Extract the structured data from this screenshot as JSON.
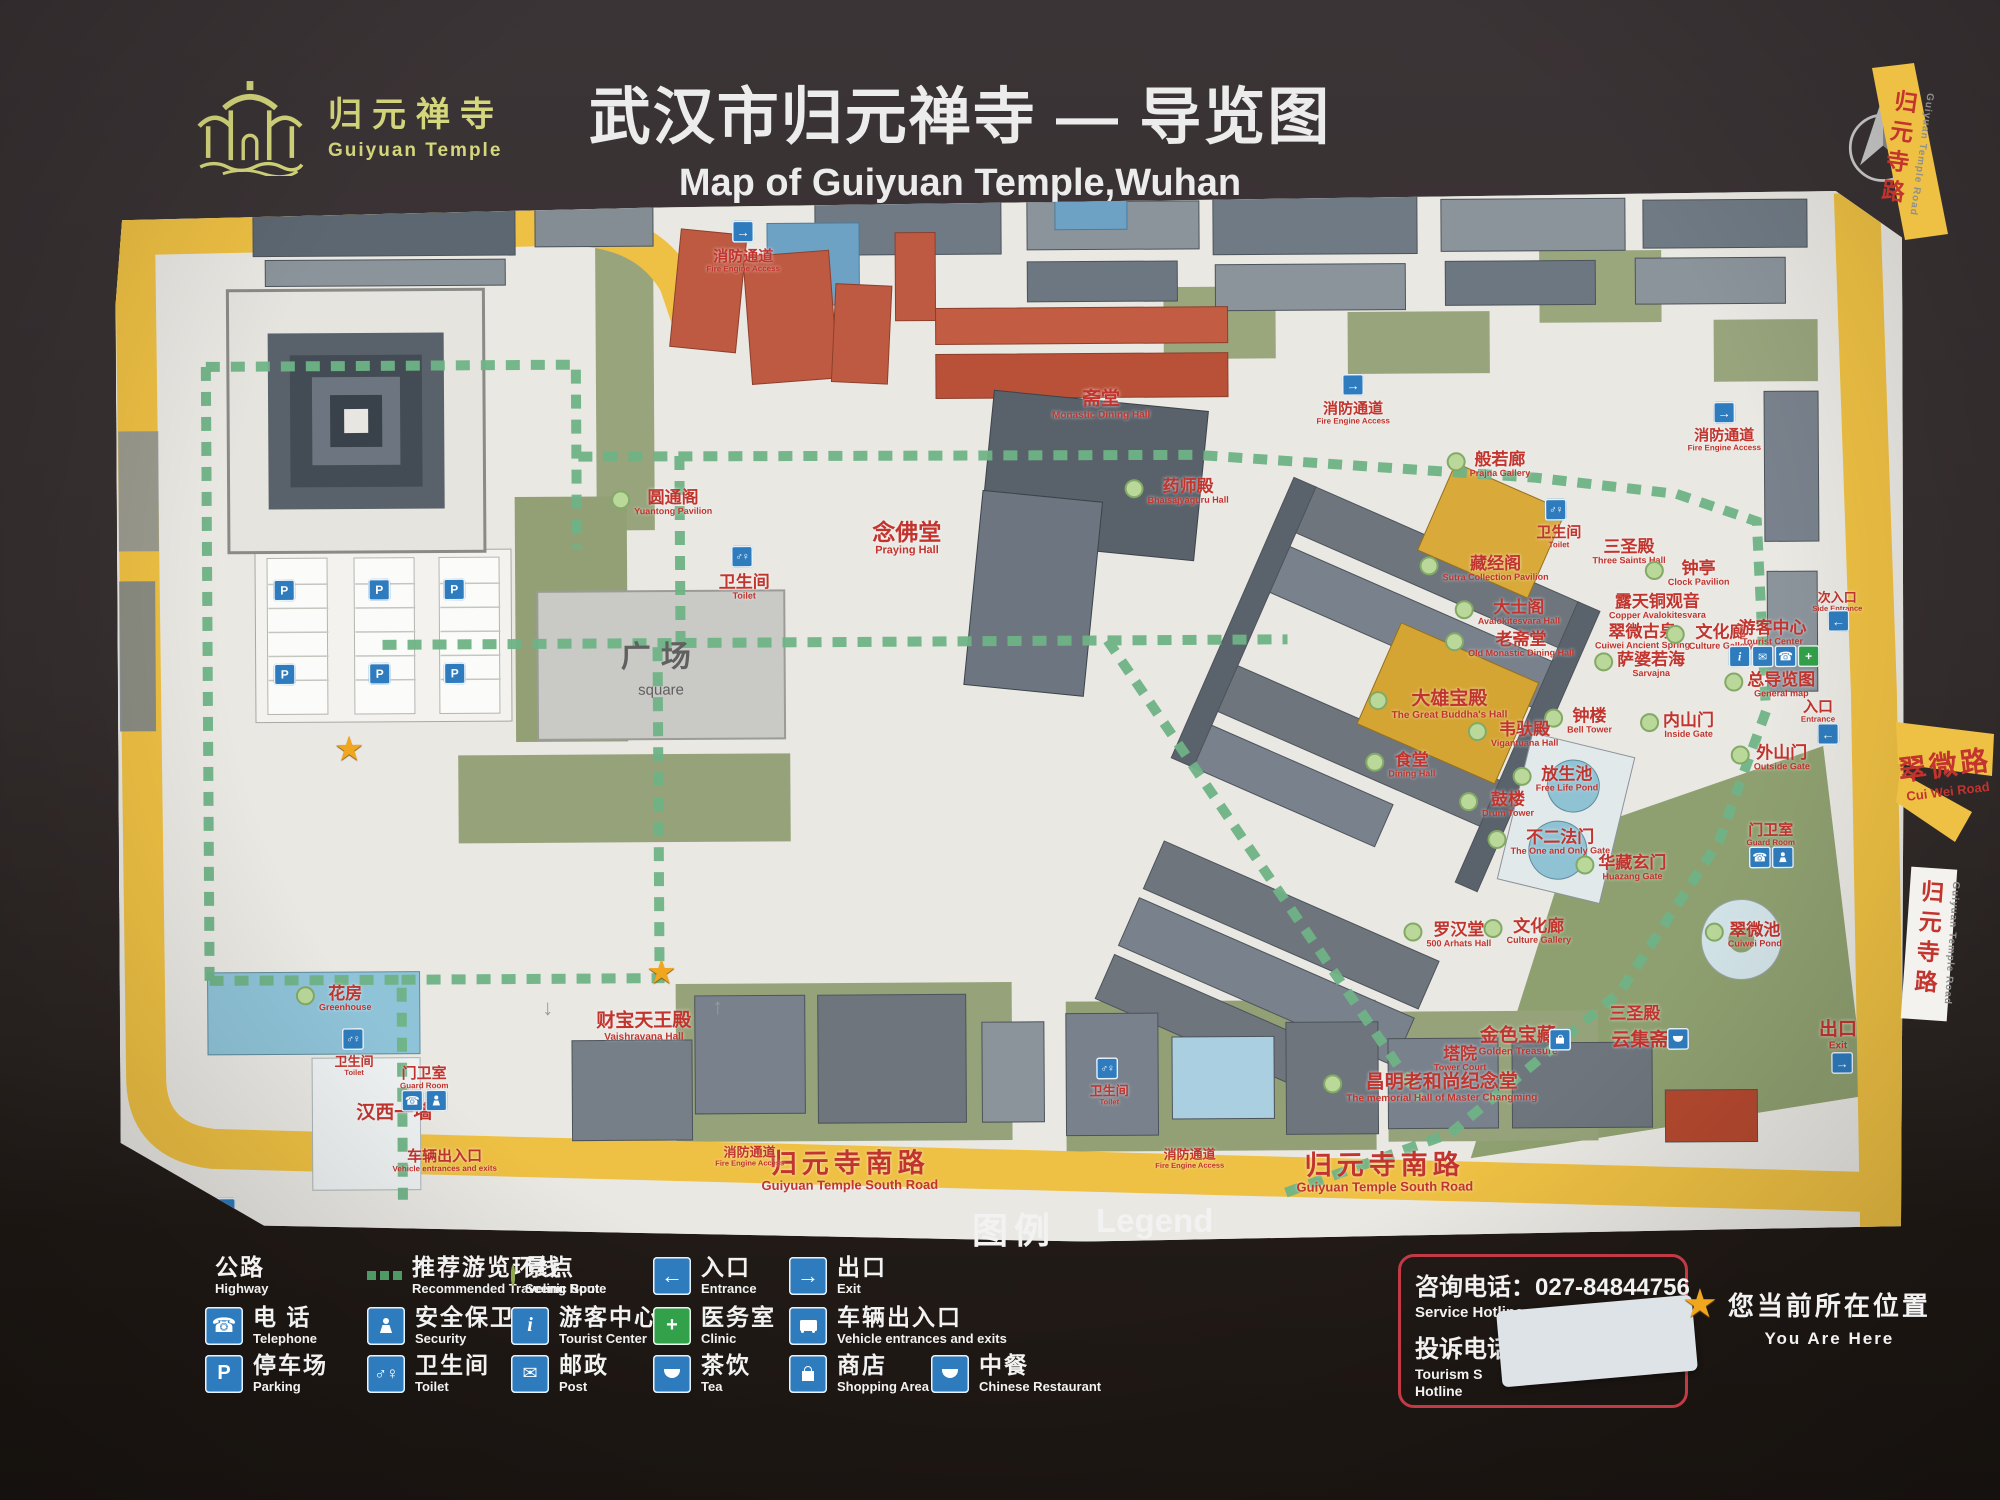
{
  "logo": {
    "cn": "归元禅寺",
    "en": "Guiyuan Temple"
  },
  "title": {
    "cn": "武汉市归元禅寺 — 导览图",
    "en": "Map of Guiyuan Temple,Wuhan"
  },
  "compass": {
    "label": "N"
  },
  "colors": {
    "road_yellow": "#eec043",
    "label_red": "#c2342e",
    "route_green": "#6fb386",
    "spot_green": "#b9d89a",
    "sign_blue": "#2e7cbe",
    "clinic_green": "#33a04a",
    "logo_yellow": "#d5d77c"
  },
  "map": {
    "square": {
      "cn": "广场",
      "en": "square"
    },
    "roads_outside": {
      "guiyuan_road": {
        "zh": "归元寺路",
        "en": "Guiyuan Temple Road"
      },
      "cuiwei_road": {
        "zh": "翠微路",
        "en": "Cui Wei Road"
      }
    },
    "labels": [
      {
        "zh": "消防通道",
        "en": "Fire Engine Access",
        "x": 628,
        "y": 64,
        "c": "sm"
      },
      {
        "zh": "圆通阁",
        "en": "Yuantong Pavilion",
        "x": 545,
        "y": 305,
        "d": 1
      },
      {
        "zh": "卫生间",
        "en": "Toilet",
        "x": 627,
        "y": 390
      },
      {
        "zh": "念佛堂",
        "en": "Praying Hall",
        "x": 790,
        "y": 342,
        "c": "lg"
      },
      {
        "zh": "斋堂",
        "en": "Monastic Dining Hall",
        "x": 985,
        "y": 210,
        "c": "md"
      },
      {
        "zh": "消防通道",
        "en": "Fire Engine Access",
        "x": 1237,
        "y": 220,
        "c": "sm"
      },
      {
        "zh": "消防通道",
        "en": "Fire Engine Access",
        "x": 1608,
        "y": 249,
        "c": "sm"
      },
      {
        "zh": "般若廊",
        "en": "Prajna Gallery",
        "x": 1372,
        "y": 272,
        "d": 1
      },
      {
        "zh": "药师殿",
        "en": "Bhaisajyaguru Hall",
        "x": 1060,
        "y": 297,
        "d": 1
      },
      {
        "zh": "藏经阁",
        "en": "Sutra Collection Pavilion",
        "x": 1367,
        "y": 376,
        "d": 1
      },
      {
        "zh": "卫生间",
        "en": "Toilet",
        "x": 1442,
        "y": 345,
        "c": "sm"
      },
      {
        "zh": "三圣殿",
        "en": "Three Saints Hall",
        "x": 1512,
        "y": 360
      },
      {
        "zh": "钟亭",
        "en": "Clock Pavilion",
        "x": 1570,
        "y": 382,
        "d": 1
      },
      {
        "zh": "露天铜观音",
        "en": "Copper Avalokitesvara",
        "x": 1540,
        "y": 415
      },
      {
        "zh": "翠微古泉",
        "en": "Cuiwei Ancient Spring",
        "x": 1525,
        "y": 445
      },
      {
        "zh": "文化廊",
        "en": "Culture Gallery",
        "x": 1592,
        "y": 446,
        "d": 1
      },
      {
        "zh": "游客中心",
        "en": "Tourist Center",
        "x": 1655,
        "y": 442
      },
      {
        "zh": "萨婆若海",
        "en": "Sarvajna",
        "x": 1522,
        "y": 473,
        "d": 1
      },
      {
        "zh": "总导览图",
        "en": "General map",
        "x": 1652,
        "y": 494,
        "d": 1
      },
      {
        "zh": "次入口",
        "en": "Side Entrance",
        "x": 1720,
        "y": 411,
        "c": "xs"
      },
      {
        "zh": "入口",
        "en": "Entrance",
        "x": 1700,
        "y": 521,
        "c": "sm"
      },
      {
        "zh": "外山门",
        "en": "Outside Gate",
        "x": 1652,
        "y": 567,
        "d": 1
      },
      {
        "zh": "内山门",
        "en": "Inside Gate",
        "x": 1559,
        "y": 534,
        "d": 1
      },
      {
        "zh": "钟楼",
        "en": "Bell Tower",
        "x": 1460,
        "y": 529,
        "d": 1
      },
      {
        "zh": "大士阁",
        "en": "Avalokitesvara Hall",
        "x": 1390,
        "y": 420,
        "d": 1
      },
      {
        "zh": "老斋堂",
        "en": "Old Monastic Dining Hall",
        "x": 1392,
        "y": 452,
        "d": 1
      },
      {
        "zh": "大雄宝殿",
        "en": "The Great Buddha's Hall",
        "x": 1320,
        "y": 512,
        "d": 1,
        "c": "md"
      },
      {
        "zh": "韦驮殿",
        "en": "Vigantuana Hall",
        "x": 1395,
        "y": 542,
        "d": 1
      },
      {
        "zh": "食堂",
        "en": "Dining Hall",
        "x": 1282,
        "y": 572,
        "d": 1
      },
      {
        "zh": "放生池",
        "en": "Free Life Pond",
        "x": 1437,
        "y": 587,
        "d": 1
      },
      {
        "zh": "鼓楼",
        "en": "Drum Tower",
        "x": 1378,
        "y": 612,
        "d": 1
      },
      {
        "zh": "不二法门",
        "en": "The One and Only Gate",
        "x": 1430,
        "y": 650,
        "d": 1
      },
      {
        "zh": "华藏玄门",
        "en": "Huazang Gate",
        "x": 1502,
        "y": 676,
        "d": 1
      },
      {
        "zh": "罗汉堂",
        "en": "500 Arhats Hall",
        "x": 1328,
        "y": 742,
        "d": 1
      },
      {
        "zh": "文化廊",
        "en": "Culture Gallery",
        "x": 1408,
        "y": 739,
        "d": 1
      },
      {
        "zh": "翠微池",
        "en": "Cuiwei Pond",
        "x": 1624,
        "y": 744,
        "d": 1
      },
      {
        "zh": "三圣殿",
        "en": "",
        "x": 1515,
        "y": 822
      },
      {
        "zh": "金色宝藏",
        "en": "Golden Treasure",
        "x": 1398,
        "y": 849,
        "c": "md"
      },
      {
        "zh": "云集斋",
        "en": "",
        "x": 1520,
        "y": 849,
        "c": "md"
      },
      {
        "zh": "塔院",
        "en": "Tower Court",
        "x": 1340,
        "y": 866
      },
      {
        "zh": "昌明老和尚纪念堂",
        "en": "The memorial Hall of Master Changming",
        "x": 1310,
        "y": 895,
        "d": 1,
        "c": "md"
      },
      {
        "zh": "出口",
        "en": "Exit",
        "x": 1718,
        "y": 845,
        "c": "md"
      },
      {
        "zh": "归元寺南路",
        "en": "Guiyuan Temple South Road",
        "x": 729,
        "y": 974,
        "c": "road"
      },
      {
        "zh": "归元寺南路",
        "en": "Guiyuan Temple South Road",
        "x": 1264,
        "y": 979,
        "c": "road"
      },
      {
        "zh": "消防通道",
        "en": "Fire Engine Access",
        "x": 629,
        "y": 959,
        "c": "xs"
      },
      {
        "zh": "消防通道",
        "en": "Fire Engine Access",
        "x": 1069,
        "y": 964,
        "c": "xs"
      },
      {
        "zh": "车辆出入口",
        "en": "Vehicle entrances and exits",
        "x": 324,
        "y": 962,
        "c": "sm"
      },
      {
        "zh": "汉西一墙",
        "en": "",
        "x": 274,
        "y": 914,
        "c": "md"
      },
      {
        "zh": "门卫室",
        "en": "Guard Room",
        "x": 304,
        "y": 879,
        "c": "sm"
      },
      {
        "zh": "门卫室",
        "en": "Guard Room",
        "x": 1652,
        "y": 644,
        "c": "sm"
      },
      {
        "zh": "花房",
        "en": "Greenhouse",
        "x": 214,
        "y": 799,
        "d": 1
      },
      {
        "zh": "财宝天王殿",
        "en": "Vaishravana Hall",
        "x": 524,
        "y": 829,
        "c": "md"
      },
      {
        "zh": "卫生间",
        "en": "Toilet",
        "x": 234,
        "y": 866,
        "c": "xs"
      },
      {
        "zh": "卫生间",
        "en": "Toilet",
        "x": 989,
        "y": 900,
        "c": "xs"
      }
    ],
    "icons": [
      {
        "t": "exit",
        "x": 628,
        "y": 34
      },
      {
        "t": "wc",
        "x": 625,
        "y": 359
      },
      {
        "t": "exit",
        "x": 1237,
        "y": 191
      },
      {
        "t": "exit",
        "x": 1608,
        "y": 221
      },
      {
        "t": "wc",
        "x": 1439,
        "y": 317
      },
      {
        "t": "info",
        "x": 1622,
        "y": 465
      },
      {
        "t": "post",
        "x": 1645,
        "y": 465
      },
      {
        "t": "phone",
        "x": 1668,
        "y": 465
      },
      {
        "t": "clinic",
        "x": 1691,
        "y": 465
      },
      {
        "t": "entrance",
        "x": 1721,
        "y": 430
      },
      {
        "t": "entrance",
        "x": 1710,
        "y": 543
      },
      {
        "t": "exit",
        "x": 1722,
        "y": 872
      },
      {
        "t": "shop",
        "x": 1440,
        "y": 847
      },
      {
        "t": "restaurant",
        "x": 1558,
        "y": 847
      },
      {
        "t": "phone",
        "x": 292,
        "y": 901
      },
      {
        "t": "guard",
        "x": 316,
        "y": 901
      },
      {
        "t": "phone",
        "x": 1641,
        "y": 666
      },
      {
        "t": "guard",
        "x": 1664,
        "y": 666
      },
      {
        "t": "wc",
        "x": 233,
        "y": 839
      },
      {
        "t": "wc",
        "x": 987,
        "y": 873
      },
      {
        "t": "bus",
        "x": 104,
        "y": 1008
      },
      {
        "t": "parking",
        "x": 167,
        "y": 390
      },
      {
        "t": "parking",
        "x": 262,
        "y": 390
      },
      {
        "t": "parking",
        "x": 337,
        "y": 390
      },
      {
        "t": "parking",
        "x": 167,
        "y": 474
      },
      {
        "t": "parking",
        "x": 262,
        "y": 474
      },
      {
        "t": "parking",
        "x": 337,
        "y": 474
      }
    ],
    "stars": [
      {
        "x": 542,
        "y": 774
      },
      {
        "x": 231,
        "y": 549
      }
    ],
    "arrows": [
      {
        "g": "↓",
        "x": 428,
        "y": 809
      },
      {
        "g": "↑",
        "x": 598,
        "y": 809
      }
    ]
  },
  "legend": {
    "heading_cn": "图例",
    "heading_en": "Legend",
    "rows": [
      [
        {
          "icon": "highway",
          "zh": "公路",
          "en": "Highway"
        },
        {
          "icon": "route",
          "zh": "推荐游览环线",
          "en": "Recommended Traveling Route"
        },
        {
          "icon": "spot",
          "zh": "景点",
          "en": "Scenic Spot"
        },
        {
          "icon": "entrance",
          "zh": "入口",
          "en": "Entrance"
        },
        {
          "icon": "exit",
          "zh": "出口",
          "en": "Exit"
        }
      ],
      [
        {
          "icon": "phone",
          "zh": "电 话",
          "en": "Telephone"
        },
        {
          "icon": "security",
          "zh": "安全保卫",
          "en": "Security"
        },
        {
          "icon": "info",
          "zh": "游客中心",
          "en": "Tourist Center"
        },
        {
          "icon": "clinic",
          "zh": "医务室",
          "en": "Clinic"
        },
        {
          "icon": "bus",
          "zh": "车辆出入口",
          "en": "Vehicle entrances and exits"
        }
      ],
      [
        {
          "icon": "parking",
          "zh": "停车场",
          "en": "Parking"
        },
        {
          "icon": "wc",
          "zh": "卫生间",
          "en": "Toilet"
        },
        {
          "icon": "post",
          "zh": "邮政",
          "en": "Post"
        },
        {
          "icon": "tea",
          "zh": "茶饮",
          "en": "Tea"
        },
        {
          "icon": "shop",
          "zh": "商店",
          "en": "Shopping Area"
        },
        {
          "icon": "restaurant",
          "zh": "中餐",
          "en": "Chinese Restaurant"
        }
      ]
    ]
  },
  "hotline": {
    "service_label": "咨询电话：",
    "service_number": "027-84844756",
    "service_en": "Service Hotline",
    "complaint_label": "投诉电话",
    "complaint_en1": "Tourism S",
    "complaint_en2": "Hotline"
  },
  "you_are_here": {
    "zh": "您当前所在位置",
    "en": "You Are Here"
  }
}
